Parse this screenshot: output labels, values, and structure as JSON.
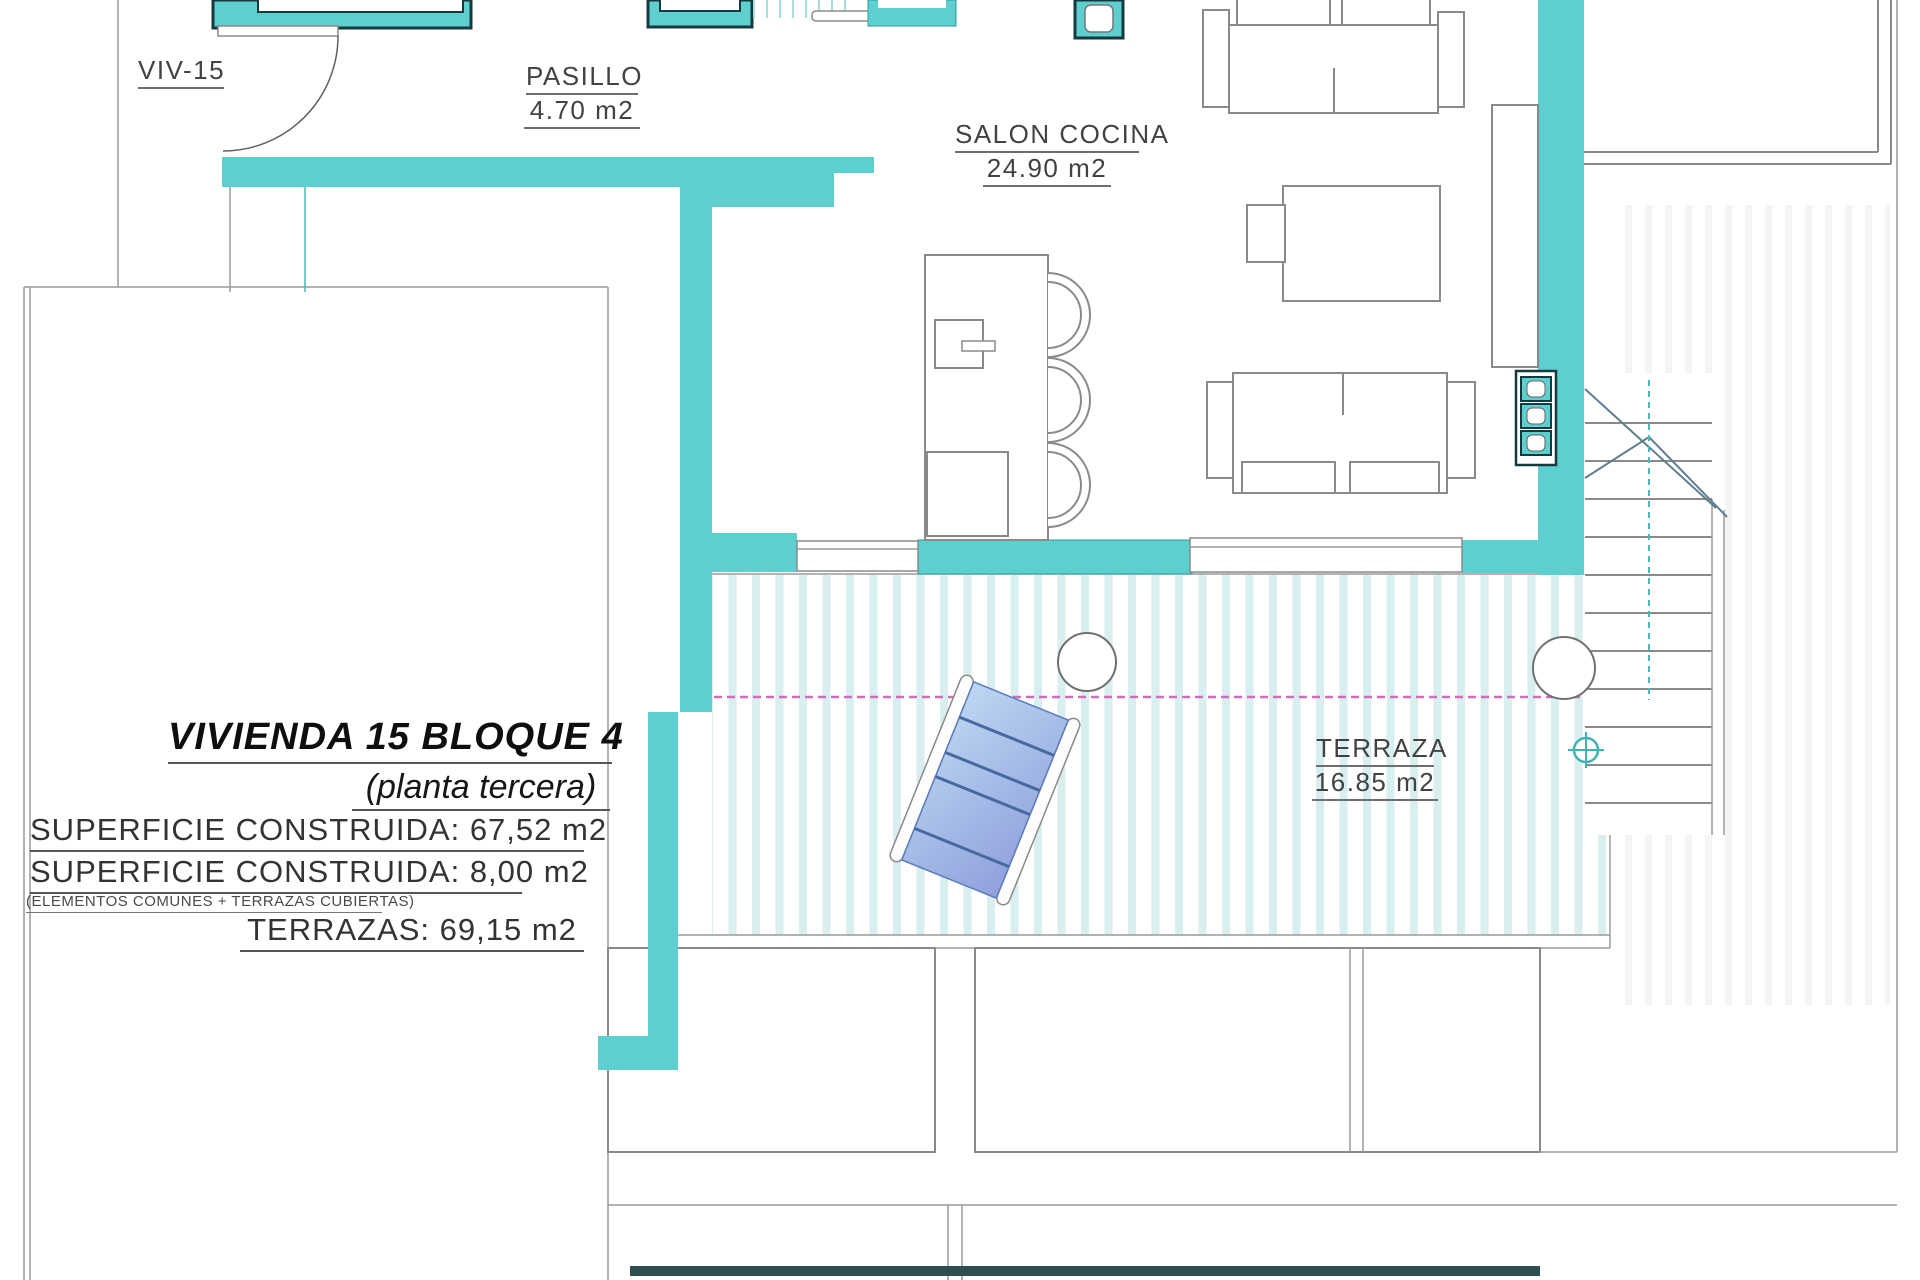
{
  "floor_plan": {
    "unit_label": "VIV-15",
    "rooms": {
      "pasillo": {
        "name": "PASILLO",
        "area": "4.70 m2"
      },
      "salon": {
        "name": "SALON COCINA",
        "area": "24.90 m2"
      },
      "terraza": {
        "name": "TERRAZA",
        "area": "16.85 m2"
      }
    },
    "title_block": {
      "title": "VIVIENDA 15 BLOQUE 4",
      "subtitle": "(planta tercera)",
      "surface_line_1": "SUPERFICIE CONSTRUIDA: 67,52 m2",
      "surface_line_2": "SUPERFICIE CONSTRUIDA: 8,00 m2",
      "surface_note": "(ELEMENTOS COMUNES + TERRAZAS CUBIERTAS)",
      "terrace_line": "TERRAZAS: 69,15 m2"
    },
    "colors": {
      "wall_teal": "#5dcfcf",
      "wall_outline_dark": "#14393f",
      "deck_stripe": "#d9eeee",
      "overhang_dashed": "#cf6cbb",
      "lounger_blue_light": "#bcd7f2",
      "lounger_blue_dark": "#90a0dc",
      "line_gray": "#8a8a8a"
    }
  }
}
